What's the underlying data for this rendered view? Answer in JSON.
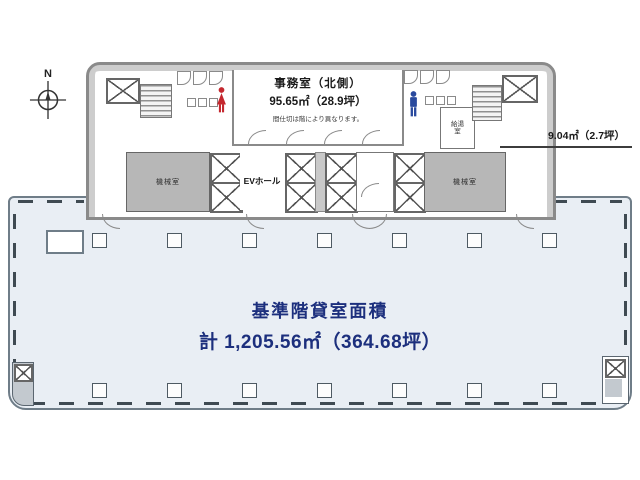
{
  "compass": {
    "north_label": "N"
  },
  "core": {
    "office": {
      "title": "事務室（北側）",
      "area": "95.65㎡（28.9坪）",
      "note": "間仕切は階により異なります。"
    },
    "ev_hall_label": "EVホール",
    "machine_room_left_label": "機械室",
    "machine_room_right_label": "機械室",
    "kitchenette_label": "給湯室"
  },
  "annotations": {
    "right_service_area": "9.04㎡（2.7坪）"
  },
  "rental_area": {
    "title": "基準階貸室面積",
    "total": "計 1,205.56㎡（364.68坪）"
  },
  "colors": {
    "title_navy": "#1c2f7d",
    "rental_fill": "#e9eef4",
    "wall_gray": "#8a8a8a",
    "machine_room_fill": "#b7b7b7",
    "female_icon_red": "#c4272e",
    "male_icon_blue": "#2a4a9e"
  },
  "icons": {
    "north_compass": "compass-icon",
    "female_restroom": "female-figure-icon",
    "male_restroom": "male-figure-icon",
    "elevator_shaft": "elevator-x-icon"
  }
}
